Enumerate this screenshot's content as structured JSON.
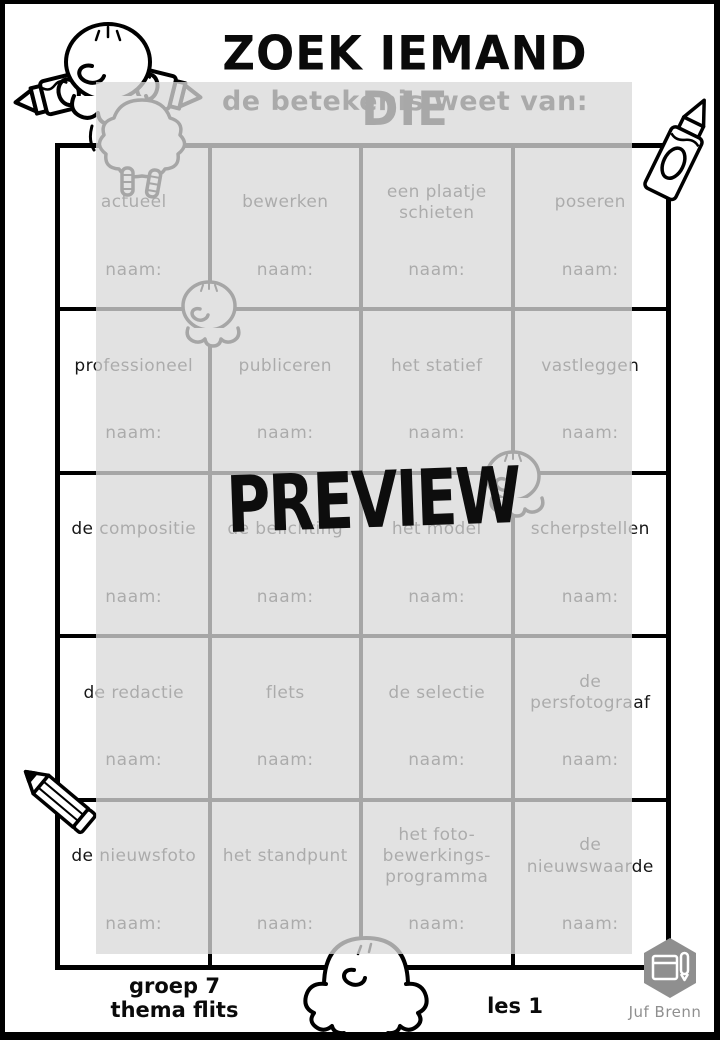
{
  "page": {
    "title": "ZOEK IEMAND DIE",
    "subtitle": "de betekenis weet van:"
  },
  "watermark": {
    "label": "PREVIEW"
  },
  "grid": {
    "naam_label": "naam:",
    "cells": [
      {
        "term": "actueel"
      },
      {
        "term": "bewerken"
      },
      {
        "term": "een plaatje\nschieten"
      },
      {
        "term": "poseren"
      },
      {
        "term": "professioneel"
      },
      {
        "term": "publiceren"
      },
      {
        "term": "het statief"
      },
      {
        "term": "vastleggen"
      },
      {
        "term": "de compositie"
      },
      {
        "term": "de belichting"
      },
      {
        "term": "het model"
      },
      {
        "term": "scherpstellen"
      },
      {
        "term": "de redactie"
      },
      {
        "term": "flets"
      },
      {
        "term": "de selectie"
      },
      {
        "term": "de\npersfotograaf"
      },
      {
        "term": "de nieuwsfoto"
      },
      {
        "term": "het standpunt"
      },
      {
        "term": "het foto-\nbewerkings-\nprogramma"
      },
      {
        "term": "de\nnieuwswaarde"
      }
    ]
  },
  "footer": {
    "group_line": "groep 7",
    "theme_line": "thema flits",
    "lesson": "les 1",
    "credit": "Juf Brenn"
  },
  "colors": {
    "ink_black": "#0a0a0a",
    "overlay_gray": "#e2e2e2",
    "muted_gray_text": "#a6a6a6",
    "logo_gray": "#8f8f8f"
  }
}
